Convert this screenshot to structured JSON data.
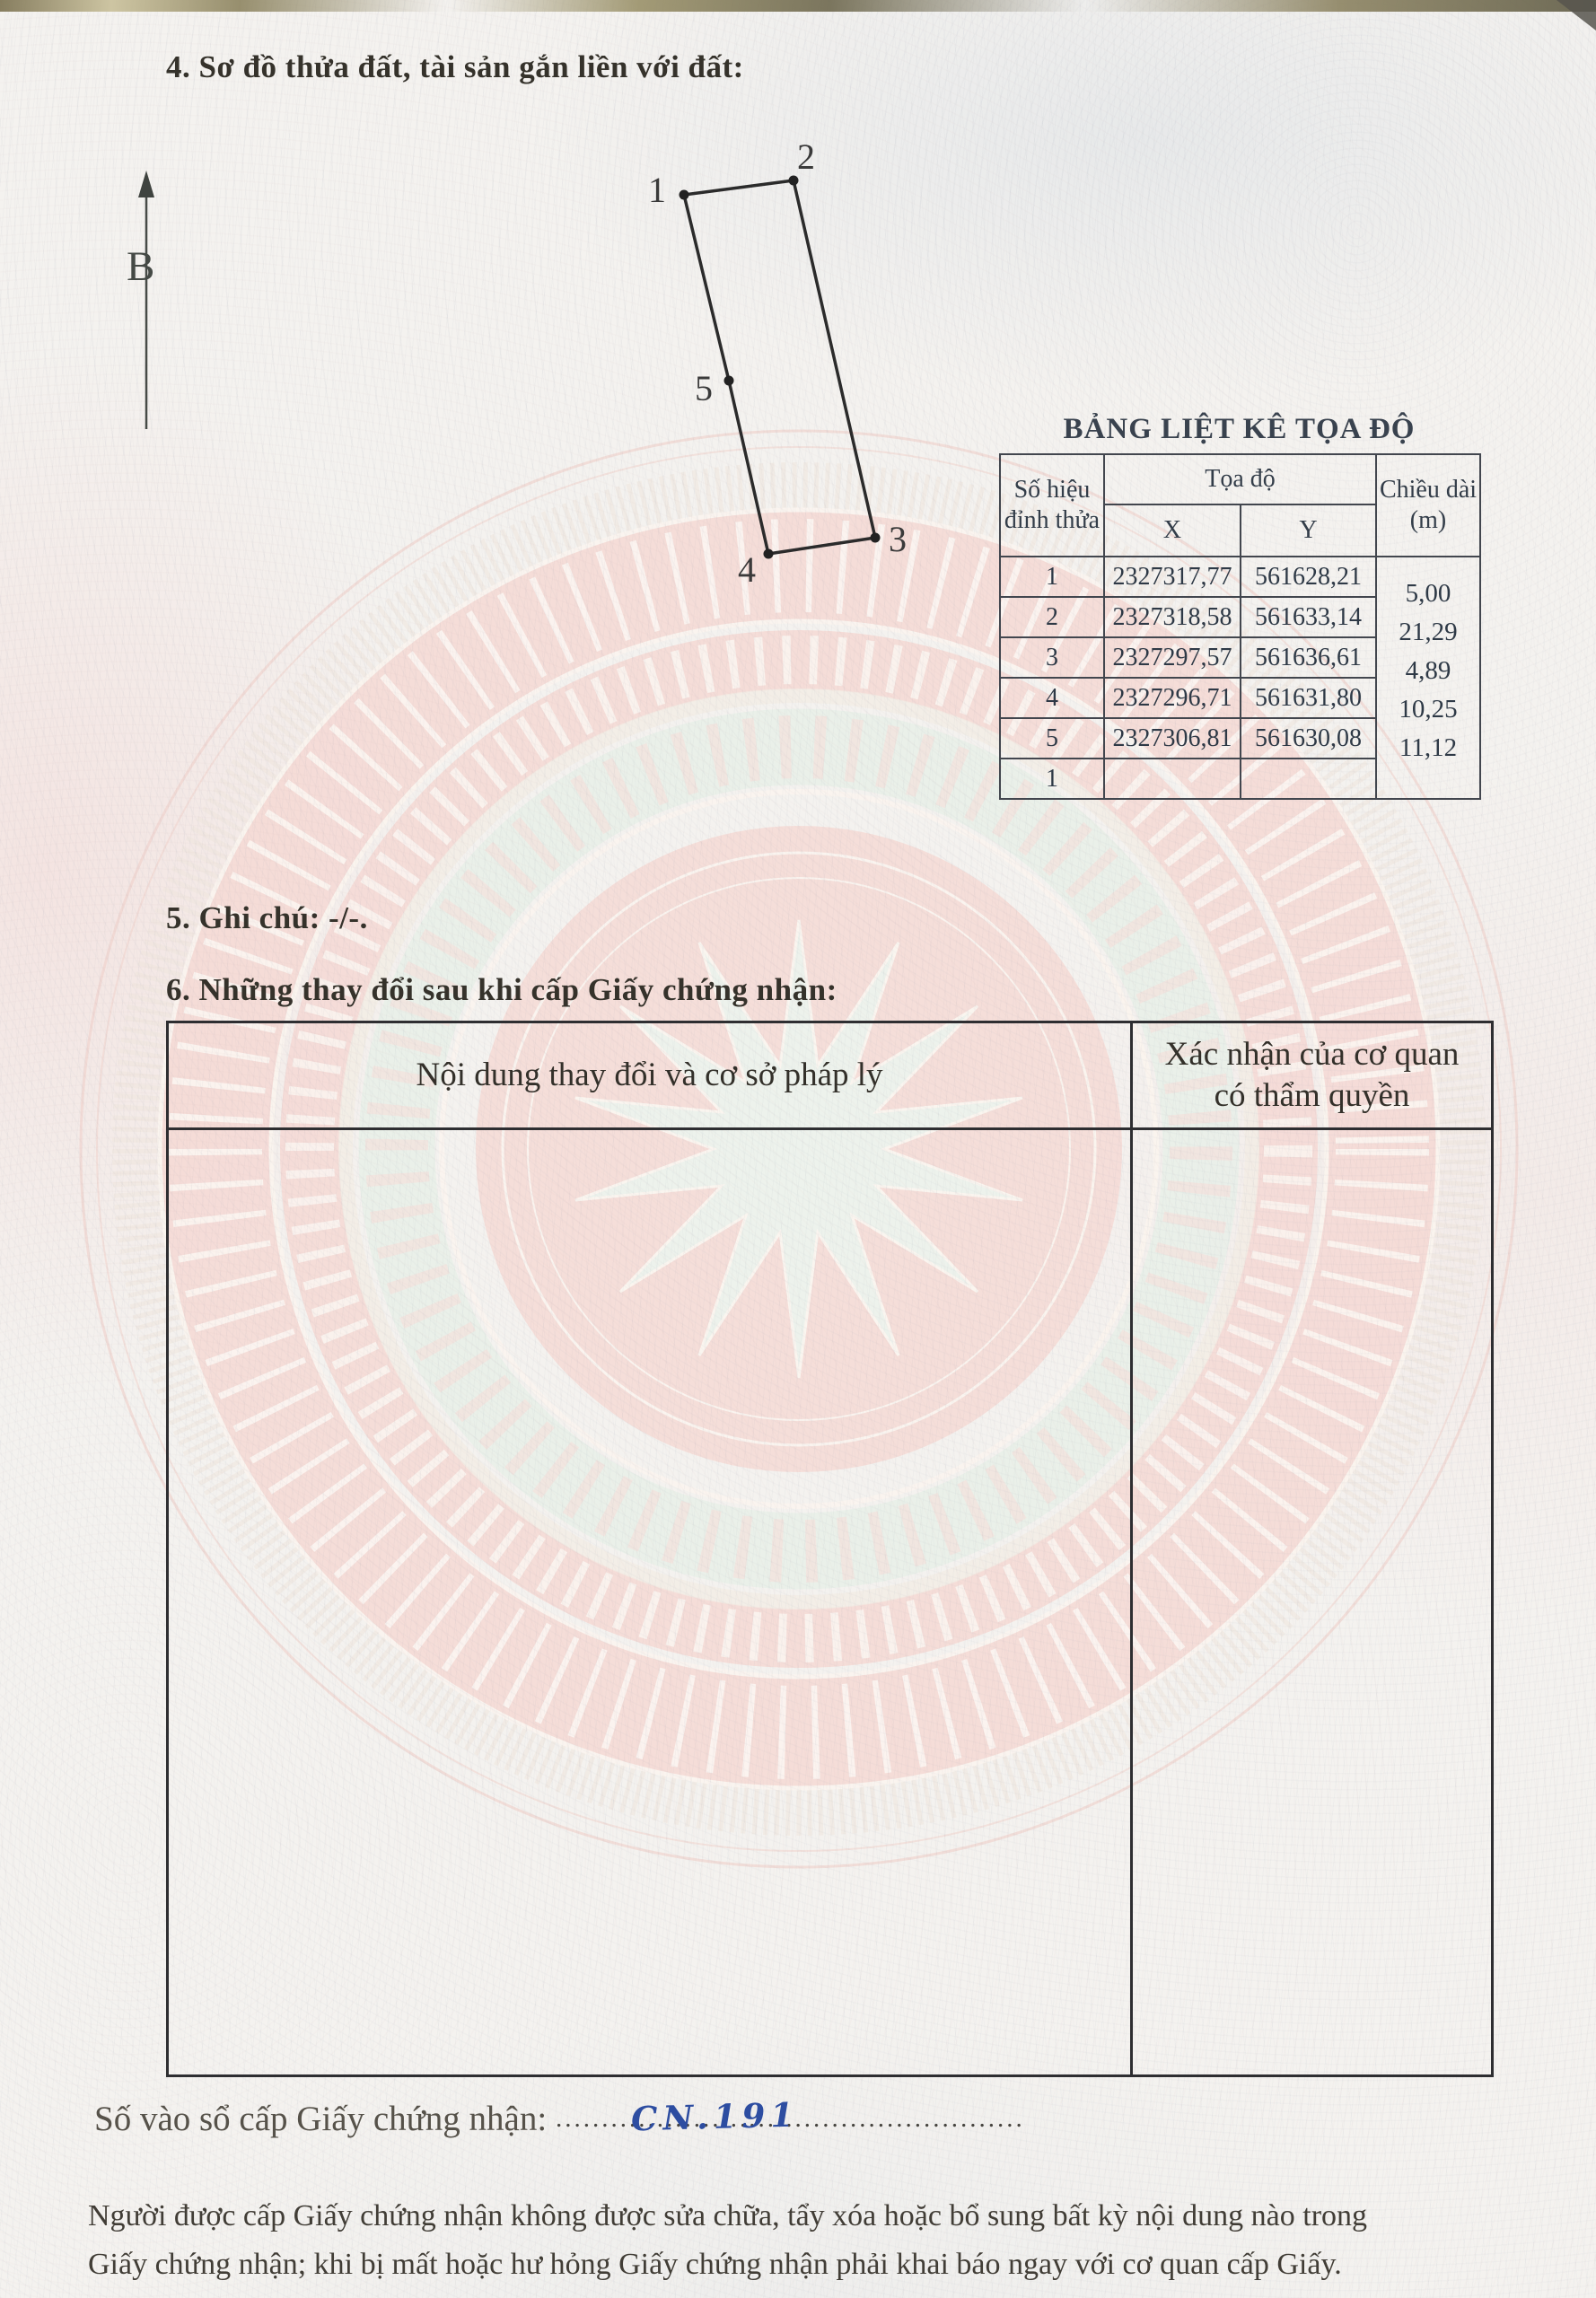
{
  "sections": {
    "s4": "4. Sơ đồ thửa đất, tài sản gắn liền với đất:",
    "s5": "5. Ghi chú: -/-.",
    "s6": "6. Những thay đổi sau khi cấp Giấy chứng nhận:"
  },
  "north": {
    "label": "B"
  },
  "diagram": {
    "v1": "1",
    "v2": "2",
    "v3": "3",
    "v4": "4",
    "v5": "5"
  },
  "coord_table": {
    "title": "BẢNG LIỆT KÊ TỌA ĐỘ",
    "col_vertex_line1": "Số hiệu",
    "col_vertex_line2": "đỉnh thửa",
    "col_group": "Tọa độ",
    "col_x": "X",
    "col_y": "Y",
    "col_len_line1": "Chiều dài",
    "col_len_line2": "(m)",
    "rows": [
      {
        "id": "1",
        "x": "2327317,77",
        "y": "561628,21"
      },
      {
        "id": "2",
        "x": "2327318,58",
        "y": "561633,14"
      },
      {
        "id": "3",
        "x": "2327297,57",
        "y": "561636,61"
      },
      {
        "id": "4",
        "x": "2327296,71",
        "y": "561631,80"
      },
      {
        "id": "5",
        "x": "2327306,81",
        "y": "561630,08"
      },
      {
        "id": "1",
        "x": "",
        "y": ""
      }
    ],
    "lengths": [
      "5,00",
      "21,29",
      "4,89",
      "10,25",
      "11,12"
    ]
  },
  "changes_table": {
    "col_content": "Nội dung thay đổi và cơ sở pháp lý",
    "col_confirm_line1": "Xác nhận của cơ quan",
    "col_confirm_line2": "có thẩm quyền"
  },
  "registry": {
    "label": "Số vào sổ cấp Giấy chứng nhận:",
    "handwritten": "CN.191",
    "dots": "..................................................."
  },
  "footer": {
    "line1": "Người được cấp Giấy chứng nhận không được sửa chữa, tẩy xóa hoặc bổ sung bất kỳ nội dung nào trong",
    "line2": "Giấy chứng nhận; khi bị mất hoặc hư hỏng Giấy chứng nhận phải khai báo ngay với cơ quan cấp Giấy."
  }
}
